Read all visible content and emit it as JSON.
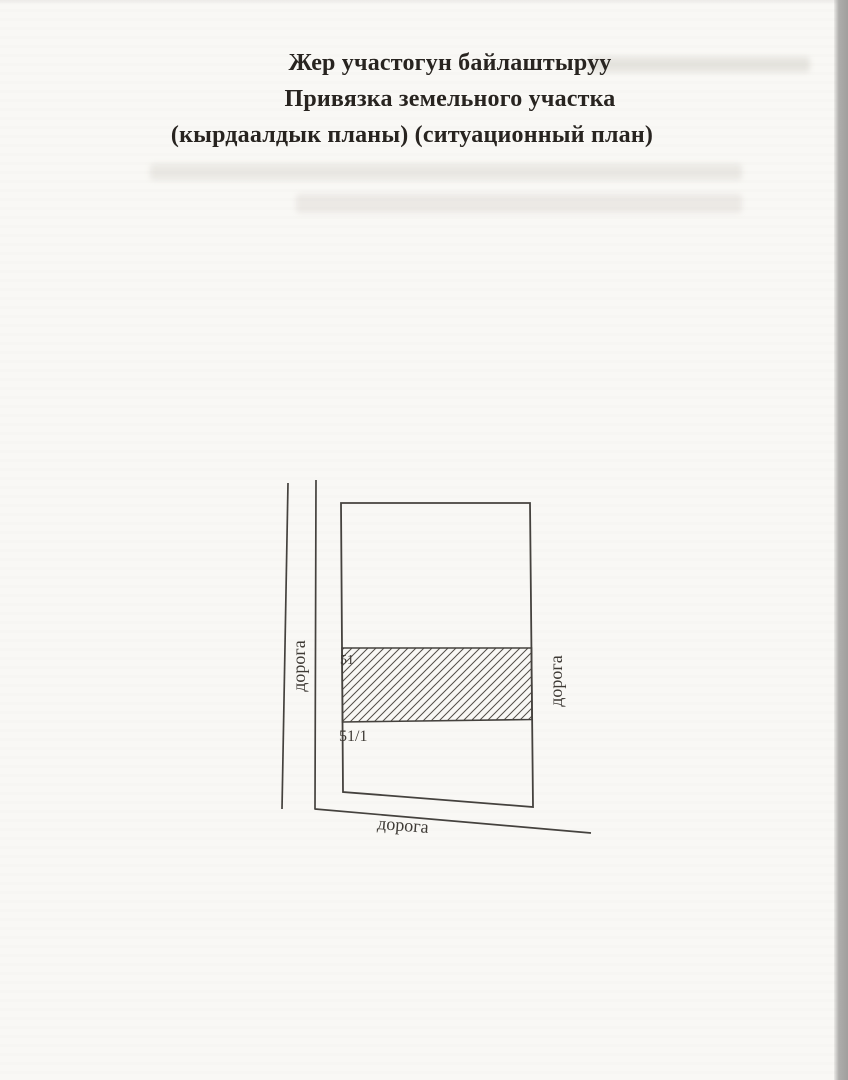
{
  "document": {
    "kind": "scanned land-plot situational plan page",
    "paper_color": "#f9f8f5",
    "ink_color": "#45423e",
    "scan_edge_color": "#a6a5a3",
    "title_lines": [
      "Жер участогун байлаштыруу",
      "Привязка земельного участка",
      "(кырдаалдык планы) (ситуационный план)"
    ]
  },
  "plan": {
    "road_labels": {
      "left": "дорога",
      "right": "дорога",
      "bottom": "дорога"
    },
    "parcels": [
      {
        "id": "51",
        "style": "hatched strip"
      },
      {
        "id": "51/1",
        "style": "empty area below strip"
      }
    ]
  }
}
